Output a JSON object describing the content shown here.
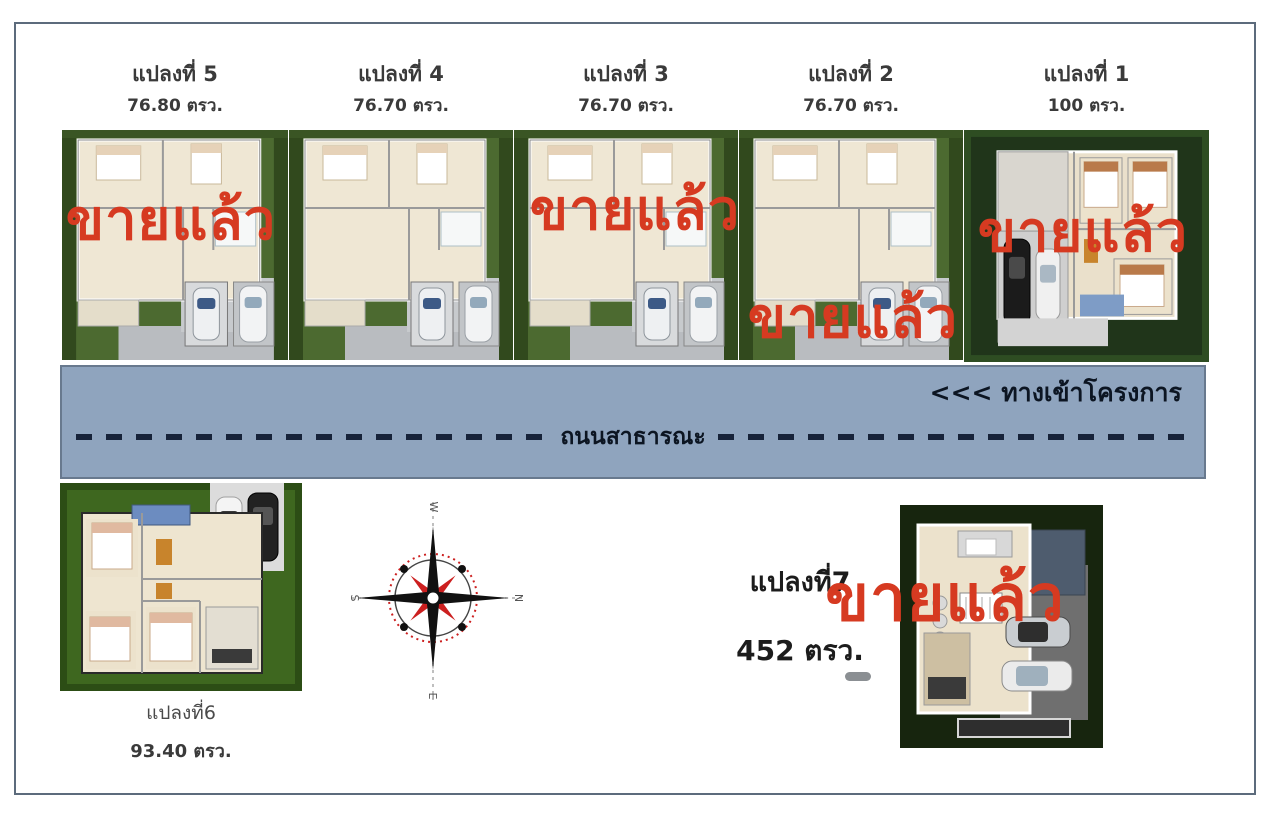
{
  "sold_label": "ขายแล้ว",
  "colors": {
    "sold_red": "#d63a21",
    "road_fill": "#8fa4be",
    "road_border": "#68798e",
    "frame_border": "#5c6b7c"
  },
  "plots_top": [
    {
      "name": "แปลงที่ 5",
      "area": "76.80 ตรว.",
      "sold": true
    },
    {
      "name": "แปลงที่ 4",
      "area": "76.70 ตรว.",
      "sold": false
    },
    {
      "name": "แปลงที่ 3",
      "area": "76.70 ตรว.",
      "sold": true
    },
    {
      "name": "แปลงที่ 2",
      "area": "76.70 ตรว.",
      "sold": true
    },
    {
      "name": "แปลงที่ 1",
      "area": "100 ตรว.",
      "sold": true
    }
  ],
  "road": {
    "entrance_label": "<<< ทางเข้าโครงการ",
    "name_label": "ถนนสาธารณะ"
  },
  "plots_bottom": {
    "plot6": {
      "name": "แปลงที่6",
      "area": "93.40 ตรว.",
      "sold": false
    },
    "plot7": {
      "name": "แปลงที่7",
      "area": "452 ตรว.",
      "sold": true
    }
  },
  "compass": {
    "north": "N",
    "east": "E",
    "south": "S",
    "west": "W"
  }
}
